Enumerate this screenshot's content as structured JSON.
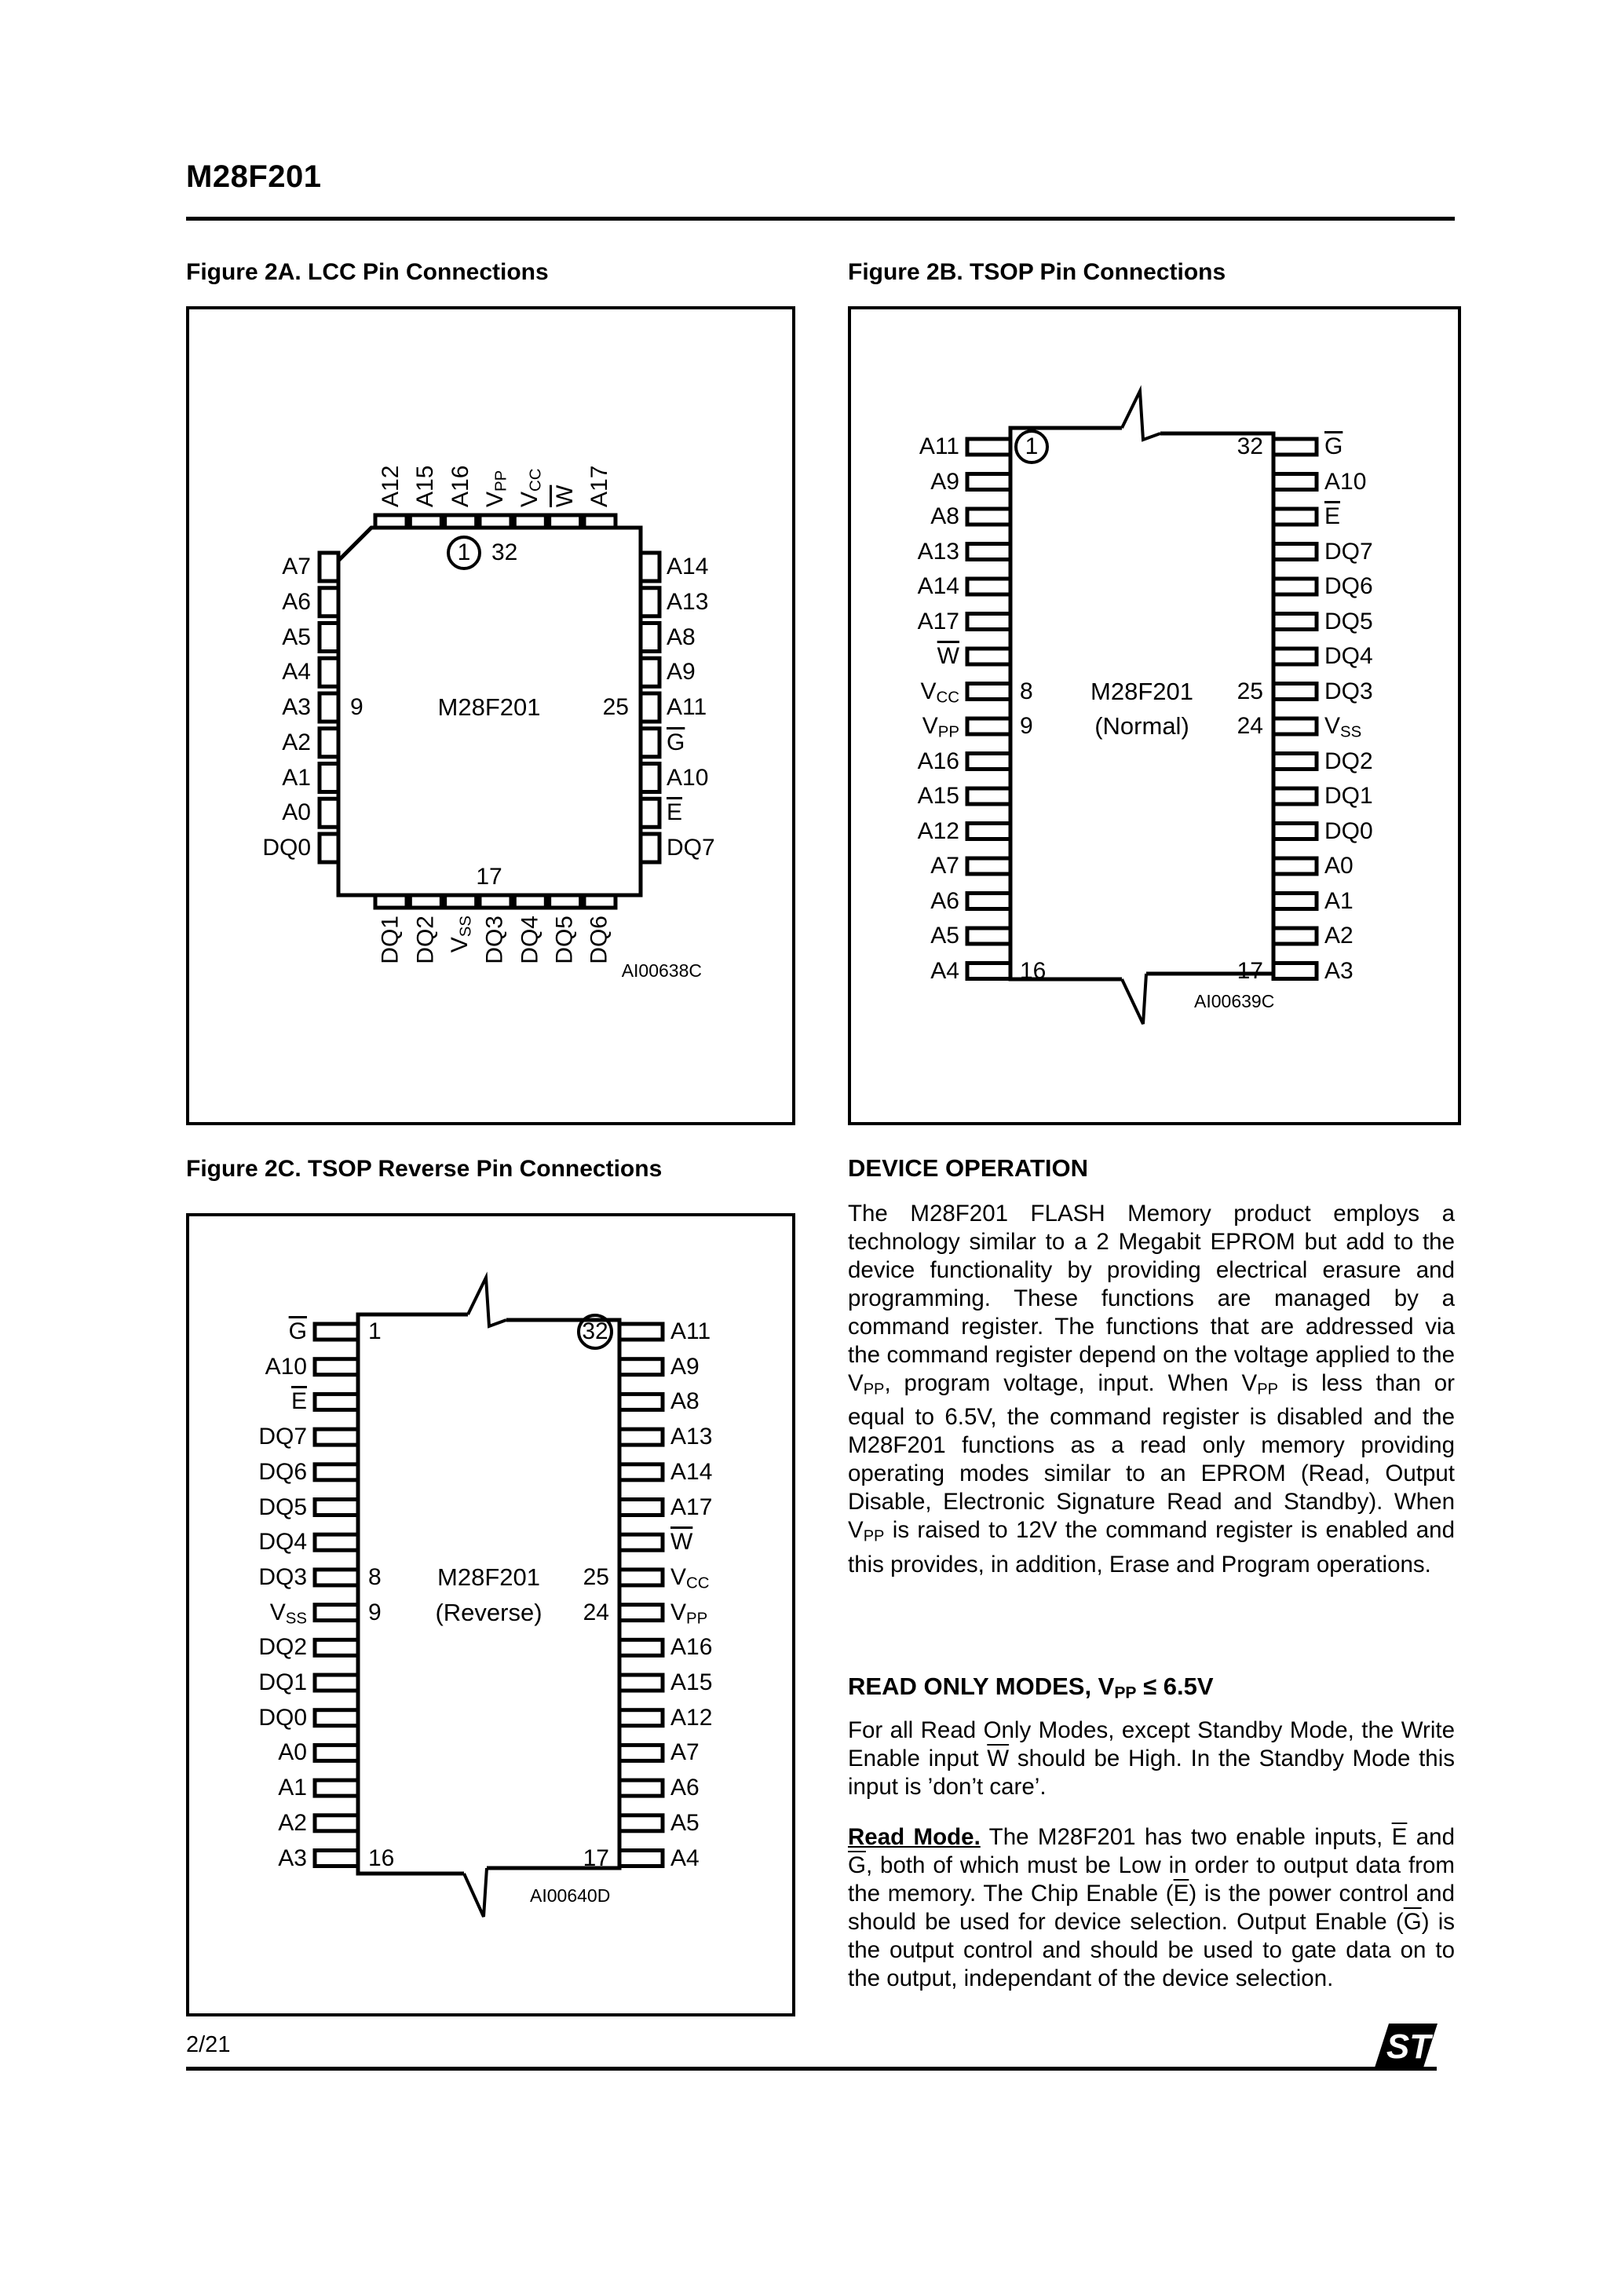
{
  "header": {
    "title": "M28F201"
  },
  "figures": {
    "fig2a": {
      "caption": "Figure 2A. LCC Pin Connections",
      "chip_name": "M28F201",
      "code": "AI00638C",
      "first_pin": "1",
      "top_right_pin": "32",
      "left_ref": "9",
      "right_ref": "25",
      "bottom_ref": "17",
      "top_pins": [
        {
          "l": "A12"
        },
        {
          "l": "A15"
        },
        {
          "l": "A16"
        },
        {
          "l": "V",
          "sub": "PP"
        },
        {
          "l": "V",
          "sub": "CC"
        },
        {
          "l": "W",
          "bar": true
        },
        {
          "l": "A17"
        }
      ],
      "left_pins": [
        {
          "l": "A7"
        },
        {
          "l": "A6"
        },
        {
          "l": "A5"
        },
        {
          "l": "A4"
        },
        {
          "l": "A3"
        },
        {
          "l": "A2"
        },
        {
          "l": "A1"
        },
        {
          "l": "A0"
        },
        {
          "l": "DQ0"
        }
      ],
      "right_pins": [
        {
          "l": "A14"
        },
        {
          "l": "A13"
        },
        {
          "l": "A8"
        },
        {
          "l": "A9"
        },
        {
          "l": "A11"
        },
        {
          "l": "G",
          "bar": true
        },
        {
          "l": "A10"
        },
        {
          "l": "E",
          "bar": true
        },
        {
          "l": "DQ7"
        }
      ],
      "bottom_pins": [
        {
          "l": "DQ1"
        },
        {
          "l": "DQ2"
        },
        {
          "l": "V",
          "sub": "SS"
        },
        {
          "l": "DQ3"
        },
        {
          "l": "DQ4"
        },
        {
          "l": "DQ5"
        },
        {
          "l": "DQ6"
        }
      ]
    },
    "fig2b": {
      "caption": "Figure 2B.  TSOP Pin Connections",
      "chip_name": "M28F201",
      "variant": "(Normal)",
      "code": "AI00639C",
      "refs": {
        "pin1": "1",
        "pin32": "32",
        "n8": "8",
        "n9": "9",
        "n25": "25",
        "n24": "24",
        "n16": "16",
        "n17": "17"
      },
      "left_pins": [
        {
          "l": "A11"
        },
        {
          "l": "A9"
        },
        {
          "l": "A8"
        },
        {
          "l": "A13"
        },
        {
          "l": "A14"
        },
        {
          "l": "A17"
        },
        {
          "l": "W",
          "bar": true
        },
        {
          "l": "V",
          "sub": "CC"
        },
        {
          "l": "V",
          "sub": "PP"
        },
        {
          "l": "A16"
        },
        {
          "l": "A15"
        },
        {
          "l": "A12"
        },
        {
          "l": "A7"
        },
        {
          "l": "A6"
        },
        {
          "l": "A5"
        },
        {
          "l": "A4"
        }
      ],
      "right_pins": [
        {
          "l": "G",
          "bar": true
        },
        {
          "l": "A10"
        },
        {
          "l": "E",
          "bar": true
        },
        {
          "l": "DQ7"
        },
        {
          "l": "DQ6"
        },
        {
          "l": "DQ5"
        },
        {
          "l": "DQ4"
        },
        {
          "l": "DQ3"
        },
        {
          "l": "V",
          "sub": "SS"
        },
        {
          "l": "DQ2"
        },
        {
          "l": "DQ1"
        },
        {
          "l": "DQ0"
        },
        {
          "l": "A0"
        },
        {
          "l": "A1"
        },
        {
          "l": "A2"
        },
        {
          "l": "A3"
        }
      ]
    },
    "fig2c": {
      "caption": "Figure 2C.  TSOP Reverse Pin Connections",
      "chip_name": "M28F201",
      "variant": "(Reverse)",
      "code": "AI00640D",
      "refs": {
        "pin1": "1",
        "pin32": "32",
        "n8": "8",
        "n9": "9",
        "n25": "25",
        "n24": "24",
        "n16": "16",
        "n17": "17"
      },
      "left_pins": [
        {
          "l": "G",
          "bar": true
        },
        {
          "l": "A10"
        },
        {
          "l": "E",
          "bar": true
        },
        {
          "l": "DQ7"
        },
        {
          "l": "DQ6"
        },
        {
          "l": "DQ5"
        },
        {
          "l": "DQ4"
        },
        {
          "l": "DQ3"
        },
        {
          "l": "V",
          "sub": "SS"
        },
        {
          "l": "DQ2"
        },
        {
          "l": "DQ1"
        },
        {
          "l": "DQ0"
        },
        {
          "l": "A0"
        },
        {
          "l": "A1"
        },
        {
          "l": "A2"
        },
        {
          "l": "A3"
        }
      ],
      "right_pins": [
        {
          "l": "A11"
        },
        {
          "l": "A9"
        },
        {
          "l": "A8"
        },
        {
          "l": "A13"
        },
        {
          "l": "A14"
        },
        {
          "l": "A17"
        },
        {
          "l": "W",
          "bar": true
        },
        {
          "l": "V",
          "sub": "CC"
        },
        {
          "l": "V",
          "sub": "PP"
        },
        {
          "l": "A16"
        },
        {
          "l": "A15"
        },
        {
          "l": "A12"
        },
        {
          "l": "A7"
        },
        {
          "l": "A6"
        },
        {
          "l": "A5"
        },
        {
          "l": "A4"
        }
      ]
    }
  },
  "sections": {
    "device_operation": {
      "heading": "DEVICE OPERATION",
      "segments": [
        {
          "t": "The M28F201 FLASH Memory product employs a technology similar to a 2 Megabit EPROM but add to the device functionality by providing electrical erasure and programming. These functions are managed by a command register. The functions that are addressed via the command register depend on the voltage applied to the V"
        },
        {
          "t": "PP",
          "sub": true
        },
        {
          "t": ", program voltage, input. When V"
        },
        {
          "t": "PP",
          "sub": true
        },
        {
          "t": " is less than or equal to 6.5V, the command register is disabled and the M28F201 functions as a read only memory providing operating modes similar to an EPROM (Read, Output Disable, Electronic Signature Read and Standby). When V"
        },
        {
          "t": "PP",
          "sub": true
        },
        {
          "t": " is raised to 12V the command register is enabled and this provides, in addition, Erase and Program operations."
        }
      ]
    },
    "read_only_modes": {
      "heading_segments": [
        {
          "t": "READ ONLY MODES, V",
          "b": true
        },
        {
          "t": "PP",
          "sub": true,
          "b": true
        },
        {
          "t": " ≤ 6.5V",
          "b": true
        }
      ],
      "standby_segments": [
        {
          "t": "For all Read Only Modes, except Standby Mode, the Write Enable input "
        },
        {
          "t": "W",
          "bar": true
        },
        {
          "t": " should be High. In the Standby Mode this input is ’don’t care’."
        }
      ],
      "read_mode_segments": [
        {
          "t": "Read Mode.",
          "b": true,
          "u": true
        },
        {
          "t": " The M28F201 has two enable inputs, "
        },
        {
          "t": "E",
          "bar": true
        },
        {
          "t": " and "
        },
        {
          "t": "G",
          "bar": true
        },
        {
          "t": ", both of which must be Low in order to output data from the memory. The Chip Enable ("
        },
        {
          "t": "E",
          "bar": true
        },
        {
          "t": ") is the power control and should be used for device selection. Output Enable ("
        },
        {
          "t": "G",
          "bar": true
        },
        {
          "t": ") is the output control and should be used to gate data on to the output, independant of the device selection."
        }
      ]
    }
  },
  "footer": {
    "page_number": "2/21",
    "logo": "st-logo"
  }
}
